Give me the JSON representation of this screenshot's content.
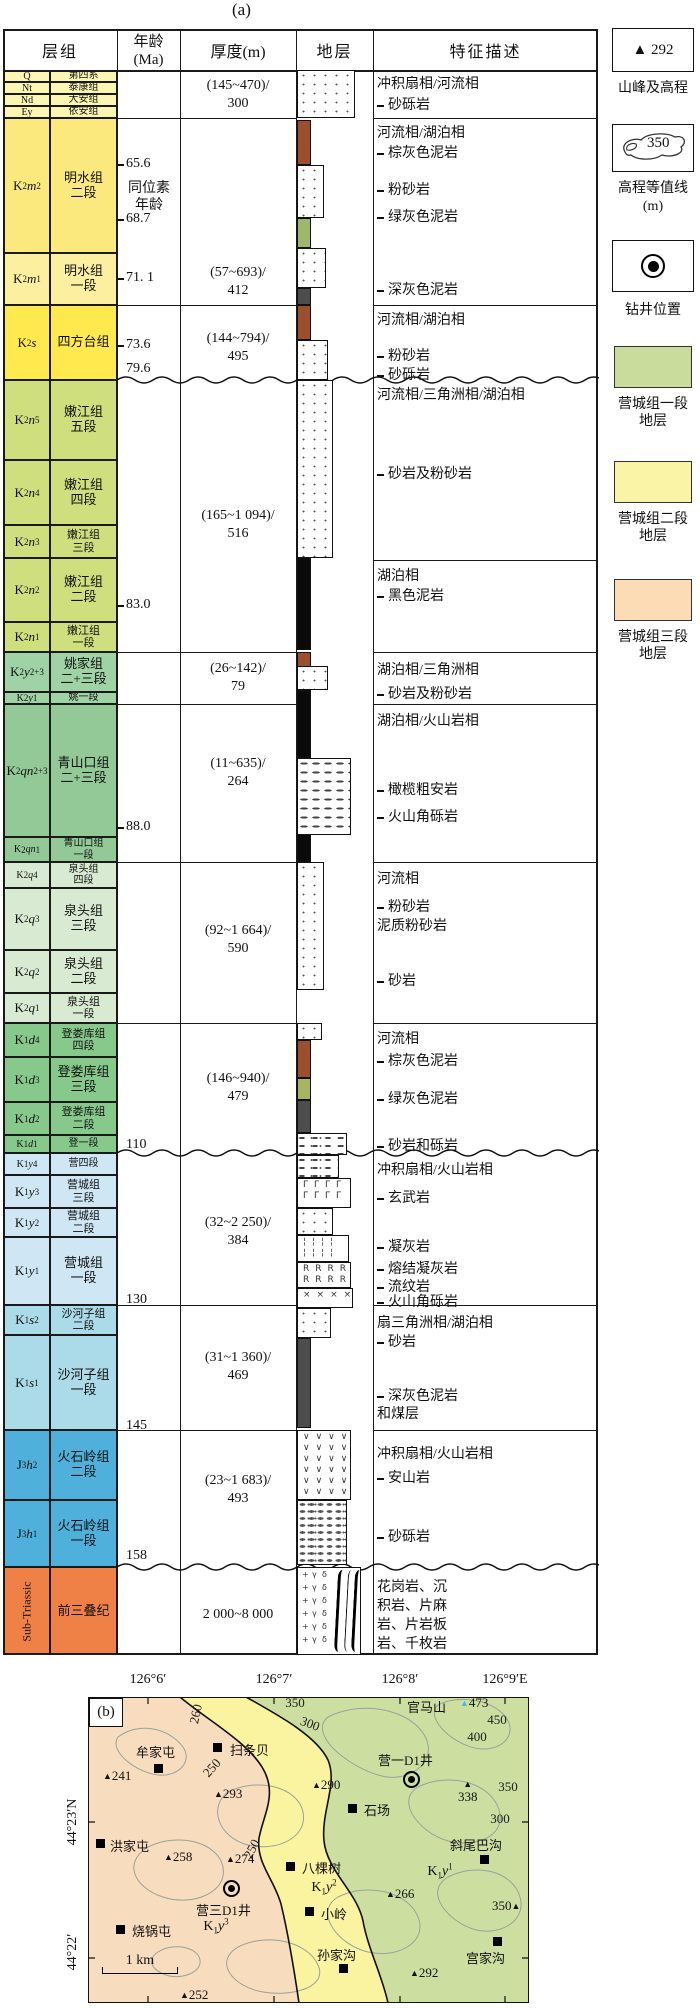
{
  "titles": {
    "a": "(a)",
    "b": "(b)"
  },
  "table": {
    "headers": {
      "col1": "层组",
      "col2a": "年龄",
      "col2b": "(Ma)",
      "col3": "厚度(m)",
      "col4": "地层",
      "col5": "特征描述"
    },
    "rows": [
      {
        "parts": [
          "Q"
        ],
        "name": "第四系",
        "y": 70,
        "h": 12,
        "c": "#FBF6B2",
        "s": 1
      },
      {
        "parts": [
          "Nt"
        ],
        "name": "泰康组",
        "y": 82,
        "h": 12,
        "c": "#FBF6B2",
        "s": 1
      },
      {
        "parts": [
          "Nd"
        ],
        "name": "大安组",
        "y": 94,
        "h": 12,
        "c": "#FBF6B2",
        "s": 1
      },
      {
        "parts": [
          "Ey"
        ],
        "name": "依安组",
        "y": 106,
        "h": 12,
        "c": "#FBF6B2",
        "s": 1
      },
      {
        "parts": [
          "K",
          "2",
          "m",
          "2"
        ],
        "name": "明水组\n二段",
        "y": 118,
        "h": 135,
        "c": "#FBE97E"
      },
      {
        "parts": [
          "K",
          "2",
          "m",
          "1"
        ],
        "name": "明水组\n一段",
        "y": 253,
        "h": 52,
        "c": "#FCF0A0"
      },
      {
        "parts": [
          "K",
          "2",
          "s",
          ""
        ],
        "name": "四方台组",
        "y": 305,
        "h": 75,
        "c": "#FFE94F"
      },
      {
        "parts": [
          "K",
          "2",
          "n",
          "5"
        ],
        "name": "嫩江组\n五段",
        "y": 380,
        "h": 80,
        "c": "#CFDF7E"
      },
      {
        "parts": [
          "K",
          "2",
          "n",
          "4"
        ],
        "name": "嫩江组\n四段",
        "y": 460,
        "h": 65,
        "c": "#CFDF7E"
      },
      {
        "parts": [
          "K",
          "2",
          "n",
          "3"
        ],
        "name": "嫩江组\n三段",
        "y": 525,
        "h": 33,
        "c": "#CFDF7E"
      },
      {
        "parts": [
          "K",
          "2",
          "n",
          "2"
        ],
        "name": "嫩江组\n二段",
        "y": 558,
        "h": 64,
        "c": "#CFDF7E"
      },
      {
        "parts": [
          "K",
          "2",
          "n",
          "1"
        ],
        "name": "嫩江组\n一段",
        "y": 622,
        "h": 30,
        "c": "#CFDF7E"
      },
      {
        "parts": [
          "K",
          "2",
          "y",
          "2+3"
        ],
        "name": "姚家组\n二+三段",
        "y": 652,
        "h": 40,
        "c": "#9FD2A5"
      },
      {
        "parts": [
          "K",
          "2",
          "y",
          "1"
        ],
        "name": "姚一段",
        "y": 692,
        "h": 12,
        "c": "#9FD2A5",
        "s": 1
      },
      {
        "parts": [
          "K",
          "2",
          "qn",
          "2+3"
        ],
        "name": "青山口组\n二+三段",
        "y": 704,
        "h": 133,
        "c": "#92C997"
      },
      {
        "parts": [
          "K",
          "2",
          "qn",
          "1"
        ],
        "name": "青山口组\n一段",
        "y": 837,
        "h": 25,
        "c": "#92C997",
        "s": 1
      },
      {
        "parts": [
          "K",
          "2",
          "q",
          "4"
        ],
        "name": "泉头组\n四段",
        "y": 862,
        "h": 26,
        "c": "#D8EAD2",
        "s": 1
      },
      {
        "parts": [
          "K",
          "2",
          "q",
          "3"
        ],
        "name": "泉头组\n三段",
        "y": 888,
        "h": 62,
        "c": "#D8EAD2"
      },
      {
        "parts": [
          "K",
          "2",
          "q",
          "2"
        ],
        "name": "泉头组\n二段",
        "y": 950,
        "h": 43,
        "c": "#D8EAD2"
      },
      {
        "parts": [
          "K",
          "2",
          "q",
          "1"
        ],
        "name": "泉头组\n一段",
        "y": 993,
        "h": 30,
        "c": "#D8EAD2"
      },
      {
        "parts": [
          "K",
          "1",
          "d",
          "4"
        ],
        "name": "登娄库组\n四段",
        "y": 1023,
        "h": 34,
        "c": "#86C98B"
      },
      {
        "parts": [
          "K",
          "1",
          "d",
          "3"
        ],
        "name": "登娄库组\n三段",
        "y": 1057,
        "h": 45,
        "c": "#86C98B"
      },
      {
        "parts": [
          "K",
          "1",
          "d",
          "2"
        ],
        "name": "登娄库组\n二段",
        "y": 1102,
        "h": 33,
        "c": "#86C98B"
      },
      {
        "parts": [
          "K",
          "1",
          "d",
          "1"
        ],
        "name": "登一段",
        "y": 1135,
        "h": 18,
        "c": "#86C98B",
        "s": 1
      },
      {
        "parts": [
          "K",
          "1",
          "y",
          "4"
        ],
        "name": "营四段",
        "y": 1153,
        "h": 22,
        "c": "#CFE6F4",
        "s": 1
      },
      {
        "parts": [
          "K",
          "1",
          "y",
          "3"
        ],
        "name": "营城组\n三段",
        "y": 1175,
        "h": 33,
        "c": "#CFE6F4"
      },
      {
        "parts": [
          "K",
          "1",
          "y",
          "2"
        ],
        "name": "营城组\n二段",
        "y": 1208,
        "h": 29,
        "c": "#CFE6F4"
      },
      {
        "parts": [
          "K",
          "1",
          "y",
          "1"
        ],
        "name": "营城组\n一段",
        "y": 1237,
        "h": 68,
        "c": "#CFE6F4"
      },
      {
        "parts": [
          "K",
          "1",
          "s",
          "2"
        ],
        "name": "沙河子组\n二段",
        "y": 1305,
        "h": 30,
        "c": "#ABDAE8"
      },
      {
        "parts": [
          "K",
          "1",
          "s",
          "1"
        ],
        "name": "沙河子组\n一段",
        "y": 1335,
        "h": 95,
        "c": "#ABDAE8"
      },
      {
        "parts": [
          "J",
          "3",
          "h",
          "2"
        ],
        "name": "火石岭组\n二段",
        "y": 1430,
        "h": 70,
        "c": "#4FB1DB"
      },
      {
        "parts": [
          "J",
          "3",
          "h",
          "1"
        ],
        "name": "火石岭组\n一段",
        "y": 1500,
        "h": 67,
        "c": "#4FB1DB"
      },
      {
        "parts": [
          "Sub-Triassic"
        ],
        "name": "前三叠纪",
        "y": 1567,
        "h": 88,
        "c": "#EF8147",
        "rot": 1
      }
    ],
    "age_labels": [
      {
        "t": "65.6",
        "y": 156,
        "dash": 1
      },
      {
        "t": "同位素",
        "y": 177,
        "note": 1
      },
      {
        "t": "年龄",
        "y": 194,
        "note": 1
      },
      {
        "t": "68.7",
        "y": 211,
        "dash": 1
      },
      {
        "t": "71. 1",
        "y": 270,
        "dash": 1
      },
      {
        "t": "73.6",
        "y": 337,
        "dash": 1
      },
      {
        "t": "79.6",
        "y": 361
      },
      {
        "t": "83.0",
        "y": 597,
        "dash": 1
      },
      {
        "t": "88.0",
        "y": 819,
        "dash": 1
      },
      {
        "t": "110",
        "y": 1137
      },
      {
        "t": "130",
        "y": 1292
      },
      {
        "t": "145",
        "y": 1418
      },
      {
        "t": "158",
        "y": 1548
      }
    ],
    "thickness": [
      {
        "l1": "(145~470)/",
        "l2": "300",
        "y": 77
      },
      {
        "l1": "(57~693)/",
        "l2": "412",
        "y": 264
      },
      {
        "l1": "(144~794)/",
        "l2": "495",
        "y": 330
      },
      {
        "l1": "(165~1 094)/",
        "l2": "516",
        "y": 507
      },
      {
        "l1": "(26~142)/",
        "l2": "79",
        "y": 660
      },
      {
        "l1": "(11~635)/",
        "l2": "264",
        "y": 755
      },
      {
        "l1": "(92~1 664)/",
        "l2": "590",
        "y": 922
      },
      {
        "l1": "(146~940)/",
        "l2": "479",
        "y": 1070
      },
      {
        "l1": "(32~2 250)/",
        "l2": "384",
        "y": 1214
      },
      {
        "l1": "(31~1 360)/",
        "l2": "469",
        "y": 1349
      },
      {
        "l1": "(23~1 683)/",
        "l2": "493",
        "y": 1472
      },
      {
        "l1": "2 000~8 000",
        "l2": "",
        "y": 1606
      }
    ],
    "group_lines": [
      118,
      305,
      652,
      704,
      862,
      1023,
      1305,
      1430
    ],
    "desc_only_lines": [
      560
    ],
    "wavy_lines": [
      380,
      1153,
      1567
    ],
    "desc_lines": [
      {
        "t": "冲积扇相/河流相",
        "y": 73
      },
      {
        "t": "砂砾岩",
        "y": 94,
        "d": 1
      },
      {
        "t": "河流相/湖泊相",
        "y": 122
      },
      {
        "t": "棕灰色泥岩",
        "y": 142,
        "d": 1
      },
      {
        "t": "粉砂岩",
        "y": 179,
        "d": 1
      },
      {
        "t": "绿灰色泥岩",
        "y": 206,
        "d": 1
      },
      {
        "t": "深灰色泥岩",
        "y": 279,
        "d": 1
      },
      {
        "t": "河流相/湖泊相",
        "y": 309
      },
      {
        "t": "粉砂岩",
        "y": 345,
        "d": 1
      },
      {
        "t": "砂砾岩",
        "y": 364,
        "d": 1
      },
      {
        "t": "河流相/三角洲相/湖泊相",
        "y": 384
      },
      {
        "t": "砂岩及粉砂岩",
        "y": 463,
        "d": 1
      },
      {
        "t": "湖泊相",
        "y": 565
      },
      {
        "t": "黑色泥岩",
        "y": 585,
        "d": 1
      },
      {
        "t": "湖泊相/三角洲相",
        "y": 659
      },
      {
        "t": "砂岩及粉砂岩",
        "y": 683,
        "d": 1
      },
      {
        "t": "湖泊相/火山岩相",
        "y": 710
      },
      {
        "t": "橄榄粗安岩",
        "y": 779,
        "d": 1
      },
      {
        "t": "火山角砾岩",
        "y": 806,
        "d": 1
      },
      {
        "t": "河流相",
        "y": 868
      },
      {
        "t": "粉砂岩",
        "y": 896,
        "d": 1
      },
      {
        "t": "泥质粉砂岩",
        "y": 915
      },
      {
        "t": "砂岩",
        "y": 970,
        "d": 1
      },
      {
        "t": "河流相",
        "y": 1028
      },
      {
        "t": "棕灰色泥岩",
        "y": 1050,
        "d": 1
      },
      {
        "t": "绿灰色泥岩",
        "y": 1088,
        "d": 1
      },
      {
        "t": "砂岩和砾岩",
        "y": 1135,
        "d": 1
      },
      {
        "t": "冲积扇相/火山岩相",
        "y": 1159
      },
      {
        "t": "玄武岩",
        "y": 1187,
        "d": 1
      },
      {
        "t": "凝灰岩",
        "y": 1236,
        "d": 1
      },
      {
        "t": "熔结凝灰岩",
        "y": 1258,
        "d": 1
      },
      {
        "t": "流纹岩",
        "y": 1276,
        "d": 1
      },
      {
        "t": "火山角砾岩",
        "y": 1291,
        "d": 1
      },
      {
        "t": "扇三角洲相/湖泊相",
        "y": 1312
      },
      {
        "t": "砂岩",
        "y": 1331,
        "d": 1
      },
      {
        "t": "深灰色泥岩",
        "y": 1385,
        "d": 1
      },
      {
        "t": "和煤层",
        "y": 1403
      },
      {
        "t": "冲积扇相/火山岩相",
        "y": 1443
      },
      {
        "t": "安山岩",
        "y": 1467,
        "d": 1
      },
      {
        "t": "砂砾岩",
        "y": 1526,
        "d": 1
      },
      {
        "t": "花岗岩、沉",
        "y": 1576
      },
      {
        "t": "积岩、片麻",
        "y": 1595
      },
      {
        "t": "岩、片岩板",
        "y": 1614
      },
      {
        "t": "岩、千枚岩",
        "y": 1633
      }
    ],
    "litho": {
      "bar_colors": {
        "brown": "#9C4F2E",
        "green": "#9DB86B",
        "gray": "#4D4D4D",
        "black": "#0A0A0A",
        "olive": "#A8B45E"
      },
      "bars": [
        {
          "c": "brown",
          "y": 120,
          "h": 45
        },
        {
          "c": "green",
          "y": 218,
          "h": 30
        },
        {
          "c": "gray",
          "y": 288,
          "h": 17
        },
        {
          "c": "brown",
          "y": 305,
          "h": 35
        },
        {
          "c": "black",
          "y": 558,
          "h": 92
        },
        {
          "c": "brown",
          "y": 652,
          "h": 16
        },
        {
          "c": "black",
          "y": 690,
          "h": 68
        },
        {
          "c": "black",
          "y": 833,
          "h": 29
        },
        {
          "c": "brown",
          "y": 1040,
          "h": 38
        },
        {
          "c": "olive",
          "y": 1078,
          "h": 22
        },
        {
          "c": "gray",
          "y": 1100,
          "h": 33
        },
        {
          "c": "gray",
          "y": 1338,
          "h": 90
        }
      ],
      "blocks": [
        {
          "p": "dots",
          "y": 70,
          "h": 48,
          "w": 58
        },
        {
          "p": "dots",
          "y": 165,
          "h": 53,
          "w": 27
        },
        {
          "p": "dots",
          "y": 248,
          "h": 40,
          "w": 29
        },
        {
          "p": "dots",
          "y": 340,
          "h": 40,
          "w": 31
        },
        {
          "p": "dots",
          "y": 380,
          "h": 178,
          "w": 36
        },
        {
          "p": "dots",
          "y": 666,
          "h": 24,
          "w": 31
        },
        {
          "p": "dashes",
          "y": 758,
          "h": 77,
          "w": 54
        },
        {
          "p": "dots",
          "y": 862,
          "h": 128,
          "w": 27
        },
        {
          "p": "dots",
          "y": 1023,
          "h": 17,
          "w": 25
        },
        {
          "p": "dashdot",
          "y": 1133,
          "h": 22,
          "w": 50
        },
        {
          "p": "dashdot",
          "y": 1155,
          "h": 23,
          "w": 42
        },
        {
          "p": "glyph",
          "g": "Γ",
          "y": 1178,
          "h": 30,
          "w": 54
        },
        {
          "p": "dots",
          "y": 1208,
          "h": 27,
          "w": 36
        },
        {
          "p": "glyph",
          "g": "¦",
          "y": 1235,
          "h": 27,
          "w": 52
        },
        {
          "p": "glyph",
          "g": "R",
          "y": 1262,
          "h": 26,
          "w": 54
        },
        {
          "p": "glyph",
          "g": "×",
          "y": 1288,
          "h": 20,
          "w": 56
        },
        {
          "p": "dots",
          "y": 1308,
          "h": 30,
          "w": 34
        },
        {
          "p": "glyph",
          "g": "∨",
          "y": 1430,
          "h": 70,
          "w": 54
        },
        {
          "p": "gravel",
          "y": 1500,
          "h": 65,
          "w": 50
        },
        {
          "p": "basement",
          "y": 1567,
          "h": 88,
          "w": 64,
          "bg": [
            "+",
            "γ",
            "δ"
          ]
        }
      ]
    }
  },
  "legend": {
    "peak": {
      "symbol": "▲",
      "value": "292",
      "label": "山峰及高程"
    },
    "contour": {
      "value": "350",
      "label": "高程等值线",
      "unit": "(m)"
    },
    "well": {
      "label": "钻井位置"
    },
    "strata": [
      {
        "color": "#C9DC9B",
        "line1": "营城组一段",
        "line2": "地层"
      },
      {
        "color": "#FAF5A6",
        "line1": "营城组二段",
        "line2": "地层"
      },
      {
        "color": "#FBDCB4",
        "line1": "营城组三段",
        "line2": "地层"
      }
    ]
  },
  "map": {
    "zone_colors": {
      "orange": "#F8DCBE",
      "yellow": "#FAF3A0",
      "green": "#CDDFA0"
    },
    "lon_labels": [
      {
        "t": "126°6′",
        "x": 148
      },
      {
        "t": "126°7′",
        "x": 274
      },
      {
        "t": "126°8′",
        "x": 400
      },
      {
        "t": "126°9′E",
        "x": 505
      }
    ],
    "lat_labels": [
      {
        "t": "44°23′N",
        "y": 1822
      },
      {
        "t": "44°22′",
        "y": 1952
      }
    ],
    "villages": [
      {
        "name": "牟家屯",
        "sx": 158,
        "sy": 1768,
        "lx": 136,
        "ly": 1742
      },
      {
        "name": "扫条贝",
        "sx": 217,
        "sy": 1747,
        "lx": 230,
        "ly": 1740
      },
      {
        "name": "洪家屯",
        "sx": 100,
        "sy": 1843,
        "lx": 110,
        "ly": 1836
      },
      {
        "name": "烧锅屯",
        "sx": 120,
        "sy": 1929,
        "lx": 132,
        "ly": 1921
      },
      {
        "name": "八棵树",
        "sx": 290,
        "sy": 1866,
        "lx": 302,
        "ly": 1858
      },
      {
        "name": "小岭",
        "sx": 309,
        "sy": 1911,
        "lx": 321,
        "ly": 1904
      },
      {
        "name": "孙家沟",
        "sx": 343,
        "sy": 1968,
        "lx": 317,
        "ly": 1945
      },
      {
        "name": "石场",
        "sx": 352,
        "sy": 1808,
        "lx": 364,
        "ly": 1800
      },
      {
        "name": "斜尾巴沟",
        "sx": 484,
        "sy": 1859,
        "lx": 450,
        "ly": 1835
      },
      {
        "name": "宫家沟",
        "sx": 497,
        "sy": 1941,
        "lx": 466,
        "ly": 1948
      },
      {
        "name": "官马山",
        "lx": 407,
        "ly": 1697
      }
    ],
    "wells": [
      {
        "name": "营一D1井",
        "sx": 411,
        "sy": 1779,
        "lx": 378,
        "ly": 1750
      },
      {
        "name": "营三D1井",
        "sx": 231,
        "sy": 1888,
        "lx": 196,
        "ly": 1900
      }
    ],
    "peaks": [
      {
        "v": "241",
        "x": 103,
        "y": 1768
      },
      {
        "v": "293",
        "x": 214,
        "y": 1786
      },
      {
        "v": "290",
        "x": 312,
        "y": 1777
      },
      {
        "v": "258",
        "x": 164,
        "y": 1849
      },
      {
        "v": "274",
        "x": 226,
        "y": 1851
      },
      {
        "v": "266",
        "x": 386,
        "y": 1886
      },
      {
        "v": "292",
        "x": 410,
        "y": 1965
      },
      {
        "v": "252",
        "x": 180,
        "y": 1987
      },
      {
        "v": "473",
        "x": 460,
        "y": 1695,
        "c": "#45B8E8"
      },
      {
        "v": "338",
        "x": 458,
        "y": 1781,
        "mode": "above"
      },
      {
        "v": "350",
        "x": 492,
        "y": 1898,
        "mode": "right"
      }
    ],
    "contour_labels": [
      {
        "t": "260",
        "x": 196,
        "y": 1714,
        "r": -78
      },
      {
        "t": "250",
        "x": 212,
        "y": 1768,
        "r": -48
      },
      {
        "t": "350",
        "x": 295,
        "y": 1703,
        "r": 0
      },
      {
        "t": "300",
        "x": 310,
        "y": 1724,
        "r": 20
      },
      {
        "t": "250",
        "x": 252,
        "y": 1849,
        "r": -62
      },
      {
        "t": "400",
        "x": 477,
        "y": 1737,
        "r": 0
      },
      {
        "t": "450",
        "x": 497,
        "y": 1720,
        "r": 0
      },
      {
        "t": "350",
        "x": 508,
        "y": 1787,
        "r": 0
      },
      {
        "t": "300",
        "x": 500,
        "y": 1819,
        "r": 0
      }
    ],
    "zone_labels": [
      {
        "parts": [
          "K",
          "1",
          "y",
          "3"
        ],
        "x": 216,
        "y": 1926
      },
      {
        "parts": [
          "K",
          "1",
          "y",
          "2"
        ],
        "x": 324,
        "y": 1887
      },
      {
        "parts": [
          "K",
          "1",
          "y",
          "1"
        ],
        "x": 440,
        "y": 1871
      }
    ],
    "scale": {
      "label": "1 km",
      "x": 102,
      "y": 1974,
      "w": 76
    }
  }
}
